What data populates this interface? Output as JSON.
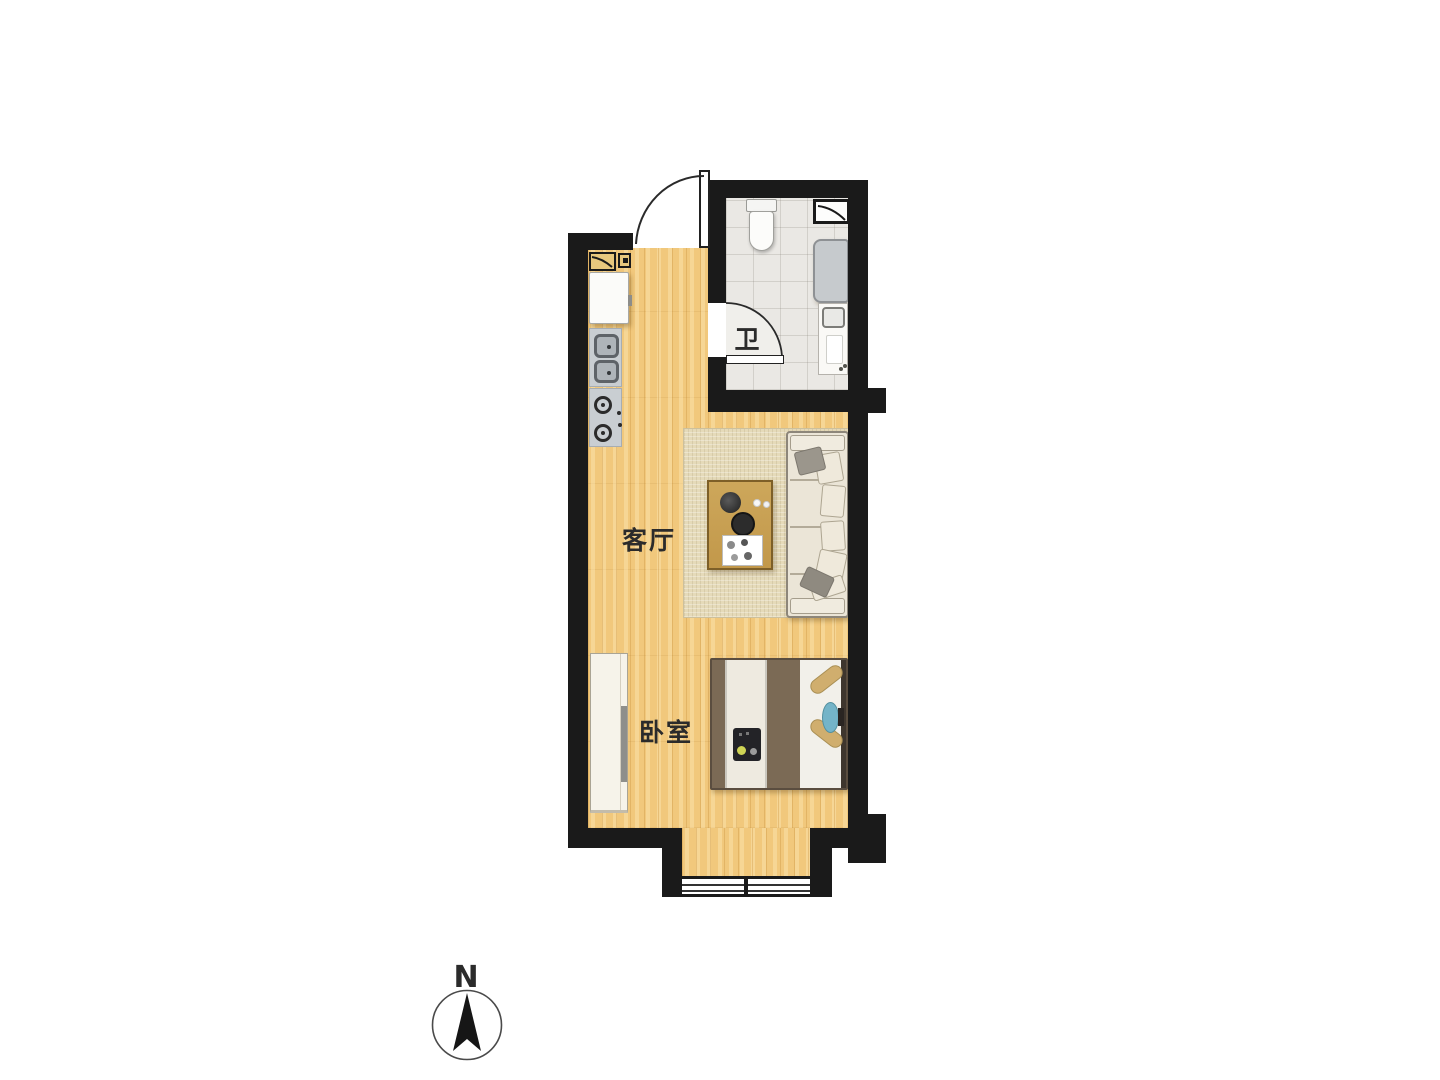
{
  "floorplan": {
    "rooms": {
      "bathroom": {
        "label": "卫"
      },
      "living_room": {
        "label": "客厅"
      },
      "bedroom": {
        "label": "卧室"
      }
    },
    "compass": {
      "north_label": "N"
    },
    "colors": {
      "wall": "#1a1a1a",
      "wood_floor": "#f1c87c",
      "tile_floor": "#eae8e4",
      "rug": "#e5dab9",
      "counter": "#c9ced2",
      "appliance_gray": "#c6cacd",
      "table_wood": "#c9a257",
      "sofa_cream": "#ebe5d7",
      "duvet_brown": "#7b6a55",
      "bolster_tan": "#d0ae6e",
      "pillow_teal": "#74b4c8",
      "flue_tan": "#e8c87e",
      "door_swing": "#f0efeb",
      "label_text": "#2b2b2b"
    }
  }
}
